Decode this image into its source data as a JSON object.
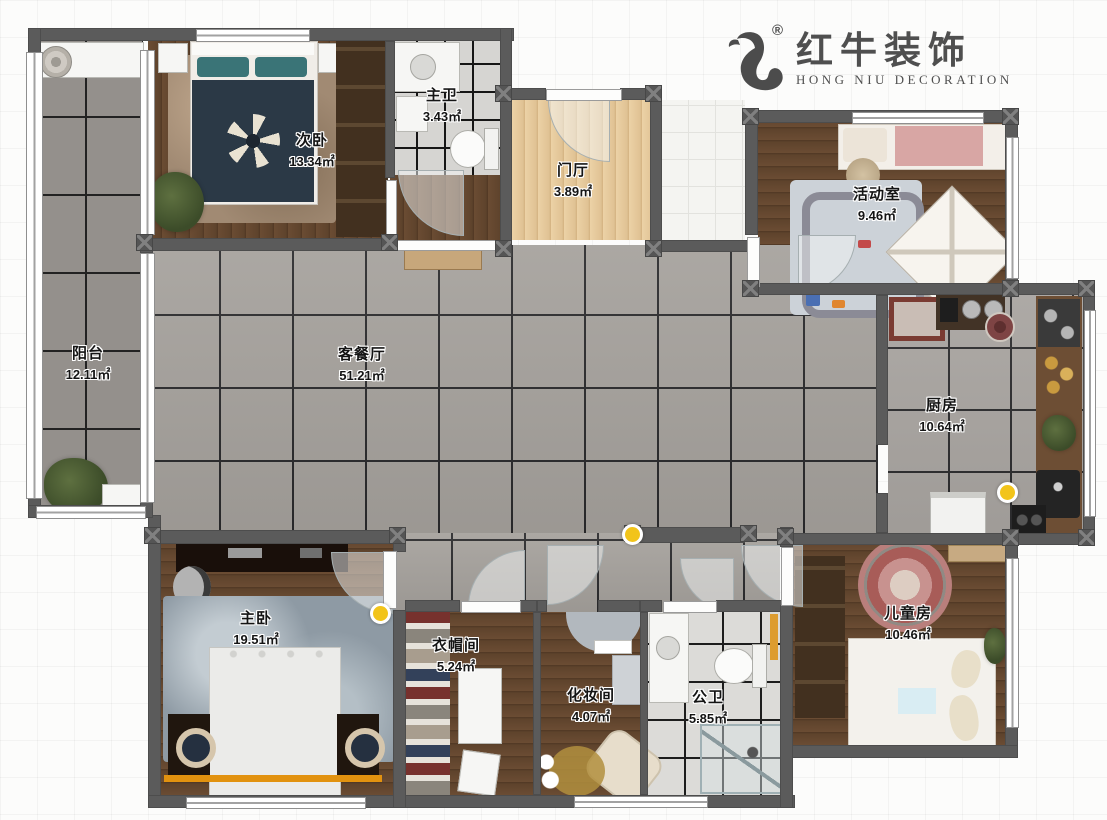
{
  "logo": {
    "brand": "红牛装饰",
    "subtitle": "HONG NIU DECORATION",
    "registered": "®"
  },
  "rooms": {
    "balcony": {
      "name": "阳台",
      "area": "12.11㎡"
    },
    "second_bedroom": {
      "name": "次卧",
      "area": "13.34㎡"
    },
    "master_bathroom": {
      "name": "主卫",
      "area": "3.43㎡"
    },
    "foyer": {
      "name": "门厅",
      "area": "3.89㎡"
    },
    "activity_room": {
      "name": "活动室",
      "area": "9.46㎡"
    },
    "living_dining": {
      "name": "客餐厅",
      "area": "51.21㎡"
    },
    "kitchen": {
      "name": "厨房",
      "area": "10.64㎡"
    },
    "master_bedroom": {
      "name": "主卧",
      "area": "19.51㎡"
    },
    "cloakroom": {
      "name": "衣帽间",
      "area": "5.24㎡"
    },
    "makeup_room": {
      "name": "化妆间",
      "area": "4.07㎡"
    },
    "public_bathroom": {
      "name": "公卫",
      "area": "5.85㎡"
    },
    "kids_room": {
      "name": "儿童房",
      "area": "10.46㎡"
    }
  },
  "colors": {
    "wall": "#5b5b5b",
    "marker_yellow": "#f2c41a",
    "headboard_strip_orange": "#e2920f",
    "brand_text": "#4f4f4f"
  }
}
